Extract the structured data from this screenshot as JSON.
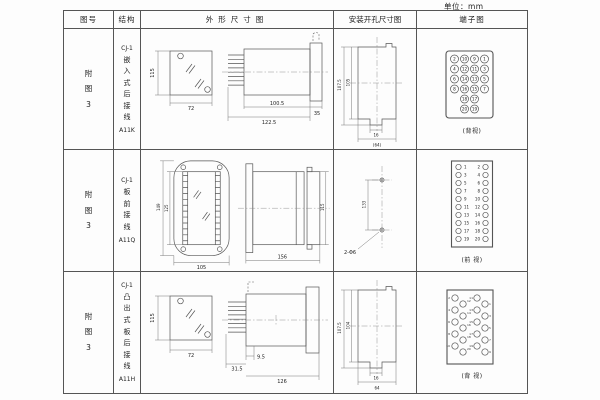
{
  "unit_label": "单位：mm",
  "headers": {
    "fig": "图号",
    "structure": "结构",
    "outline": "外形尺寸图",
    "mounting": "安装开孔尺寸图",
    "terminal": "端子图"
  },
  "rows": [
    {
      "fig": "附图3",
      "model": "CJ-1",
      "structure": "嵌入式后接线",
      "code": "A11K",
      "outline": {
        "front_h": "115",
        "front_w": "72",
        "d1": "100.5",
        "d2": "122.5",
        "d3": "35"
      },
      "mounting": {
        "v1": "107.5",
        "v2": "105",
        "h1": "16",
        "h2": "(64)"
      },
      "terminal": {
        "caption": "(背视)",
        "grid": [
          [
            "2",
            "10",
            "9",
            "1"
          ],
          [
            "4",
            "12",
            "11",
            "3"
          ],
          [
            "6",
            "14",
            "13",
            "5"
          ],
          [
            "8",
            "16",
            "15",
            "7"
          ],
          [
            "18",
            "17"
          ],
          [
            "20",
            "19"
          ]
        ]
      }
    },
    {
      "fig": "附图3",
      "model": "CJ-1",
      "structure": "板前接线",
      "code": "A11Q",
      "outline": {
        "oh": "149",
        "ih": "125",
        "w": "105",
        "len": "156",
        "side_h": "115"
      },
      "mounting": {
        "v1": "133",
        "label": "2-Φ6"
      },
      "terminal": {
        "caption": "(前 视)",
        "left": [
          "1",
          "3",
          "5",
          "7",
          "9",
          "11",
          "13",
          "15",
          "17",
          "19"
        ],
        "right": [
          "2",
          "4",
          "6",
          "8",
          "10",
          "12",
          "14",
          "16",
          "18",
          "20"
        ]
      }
    },
    {
      "fig": "附图3",
      "model": "CJ-1",
      "structure": "凸出式板后接线",
      "code": "A11H",
      "outline": {
        "front_h": "115",
        "front_w": "72",
        "d1": "31.5",
        "d2": "9.5",
        "d3": "126"
      },
      "mounting": {
        "v1": "107.5",
        "v2": "104",
        "h1": "16",
        "h2": "64"
      },
      "terminal": {
        "caption": "(背 视)",
        "left_pairs": [
          [
            "2",
            "12"
          ],
          [
            "4",
            "14"
          ],
          [
            "6",
            "16"
          ],
          [
            "8",
            "18"
          ],
          [
            "10",
            "20"
          ]
        ],
        "right_pairs": [
          [
            "11",
            "1"
          ],
          [
            "13",
            "3"
          ],
          [
            "15",
            "5"
          ],
          [
            "17",
            "7"
          ],
          [
            "19",
            "9"
          ]
        ]
      }
    }
  ]
}
